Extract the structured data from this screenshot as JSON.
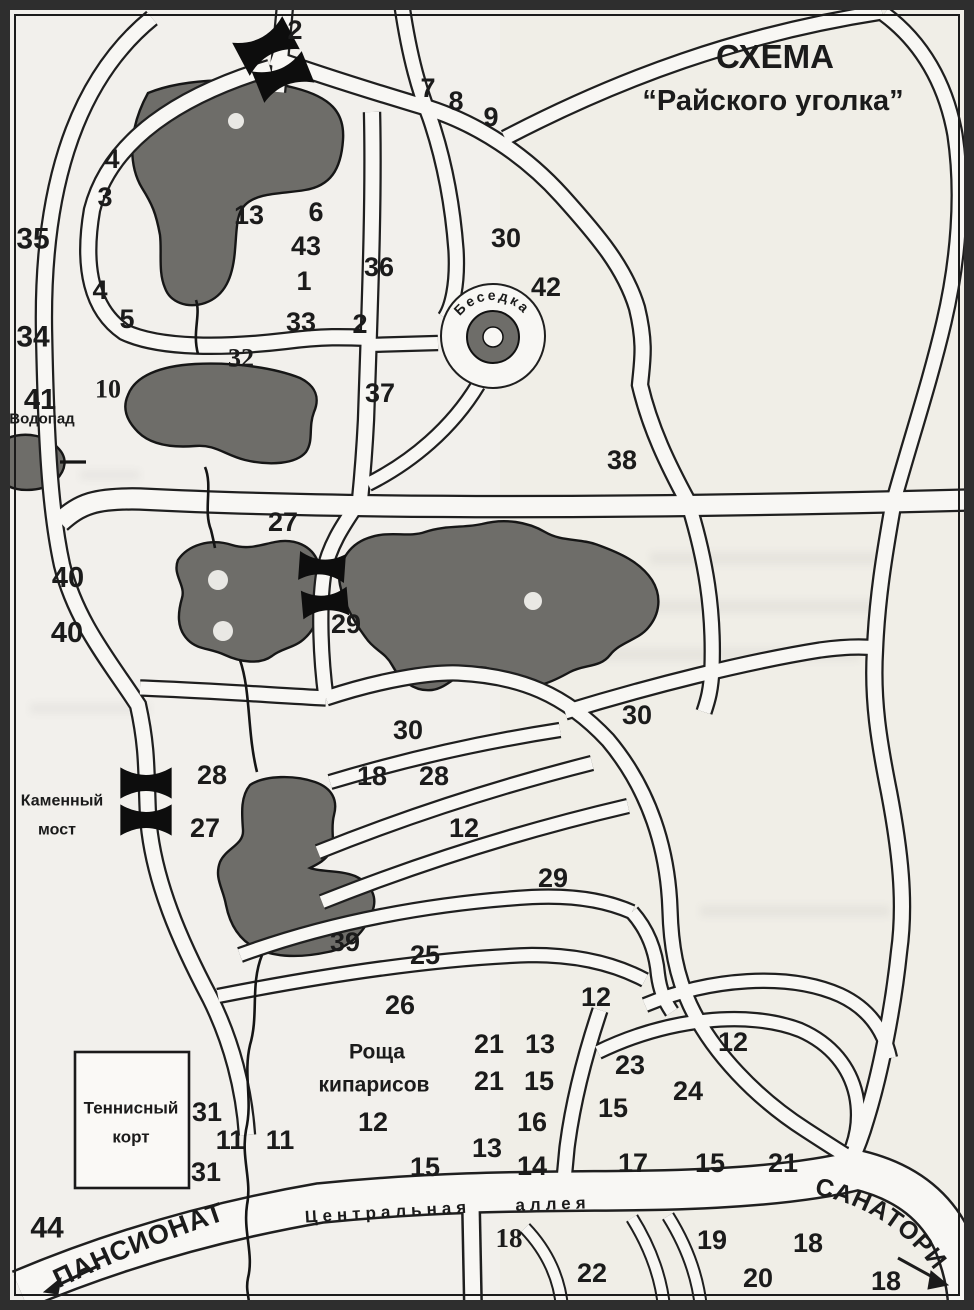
{
  "title": {
    "line1": "СХЕМА",
    "line2": "“Райского уголка”"
  },
  "colors": {
    "paper": "#f2f0ec",
    "road_fill": "#f8f7f4",
    "outline": "#1f1f1f",
    "pond": "#6e6d69",
    "border": "#2e2e2e",
    "text": "#1b1b1b"
  },
  "numbers": [
    {
      "t": "2",
      "x": 295,
      "y": 30
    },
    {
      "t": "7",
      "x": 428,
      "y": 88
    },
    {
      "t": "8",
      "x": 456,
      "y": 101
    },
    {
      "t": "9",
      "x": 491,
      "y": 117
    },
    {
      "t": "4",
      "x": 112,
      "y": 159
    },
    {
      "t": "3",
      "x": 105,
      "y": 197
    },
    {
      "t": "35",
      "x": 33,
      "y": 239,
      "s": 30
    },
    {
      "t": "13",
      "x": 249,
      "y": 215
    },
    {
      "t": "6",
      "x": 316,
      "y": 212
    },
    {
      "t": "43",
      "x": 306,
      "y": 246
    },
    {
      "t": "1",
      "x": 304,
      "y": 281
    },
    {
      "t": "36",
      "x": 379,
      "y": 267
    },
    {
      "t": "30",
      "x": 506,
      "y": 238
    },
    {
      "t": "42",
      "x": 546,
      "y": 287
    },
    {
      "t": "4",
      "x": 100,
      "y": 290
    },
    {
      "t": "5",
      "x": 127,
      "y": 319
    },
    {
      "t": "34",
      "x": 33,
      "y": 337,
      "s": 30
    },
    {
      "t": "33",
      "x": 301,
      "y": 322
    },
    {
      "t": "2",
      "x": 360,
      "y": 324
    },
    {
      "t": "32",
      "x": 241,
      "y": 358,
      "f": 1,
      "s": 26
    },
    {
      "t": "10",
      "x": 108,
      "y": 389,
      "f": 1,
      "s": 26
    },
    {
      "t": "41",
      "x": 40,
      "y": 400,
      "s": 29
    },
    {
      "t": "37",
      "x": 380,
      "y": 393
    },
    {
      "t": "38",
      "x": 622,
      "y": 460
    },
    {
      "t": "27",
      "x": 283,
      "y": 522
    },
    {
      "t": "40",
      "x": 68,
      "y": 578,
      "s": 29
    },
    {
      "t": "40",
      "x": 67,
      "y": 633,
      "s": 29
    },
    {
      "t": "29",
      "x": 346,
      "y": 624
    },
    {
      "t": "30",
      "x": 637,
      "y": 715
    },
    {
      "t": "30",
      "x": 408,
      "y": 730
    },
    {
      "t": "28",
      "x": 212,
      "y": 775
    },
    {
      "t": "18",
      "x": 372,
      "y": 776
    },
    {
      "t": "28",
      "x": 434,
      "y": 776
    },
    {
      "t": "27",
      "x": 205,
      "y": 828
    },
    {
      "t": "12",
      "x": 464,
      "y": 828
    },
    {
      "t": "29",
      "x": 553,
      "y": 878
    },
    {
      "t": "39",
      "x": 345,
      "y": 942
    },
    {
      "t": "25",
      "x": 425,
      "y": 955
    },
    {
      "t": "26",
      "x": 400,
      "y": 1005
    },
    {
      "t": "12",
      "x": 596,
      "y": 997
    },
    {
      "t": "21",
      "x": 489,
      "y": 1044
    },
    {
      "t": "13",
      "x": 540,
      "y": 1044
    },
    {
      "t": "21",
      "x": 489,
      "y": 1081
    },
    {
      "t": "15",
      "x": 539,
      "y": 1081
    },
    {
      "t": "23",
      "x": 630,
      "y": 1065
    },
    {
      "t": "24",
      "x": 688,
      "y": 1091
    },
    {
      "t": "12",
      "x": 733,
      "y": 1042
    },
    {
      "t": "15",
      "x": 613,
      "y": 1108
    },
    {
      "t": "31",
      "x": 207,
      "y": 1112
    },
    {
      "t": "11",
      "x": 230,
      "y": 1140
    },
    {
      "t": "11",
      "x": 280,
      "y": 1140
    },
    {
      "t": "31",
      "x": 206,
      "y": 1172
    },
    {
      "t": "12",
      "x": 373,
      "y": 1122
    },
    {
      "t": "16",
      "x": 532,
      "y": 1122
    },
    {
      "t": "13",
      "x": 487,
      "y": 1148
    },
    {
      "t": "14",
      "x": 532,
      "y": 1166
    },
    {
      "t": "15",
      "x": 425,
      "y": 1167
    },
    {
      "t": "17",
      "x": 633,
      "y": 1163
    },
    {
      "t": "15",
      "x": 710,
      "y": 1163
    },
    {
      "t": "21",
      "x": 783,
      "y": 1163
    },
    {
      "t": "44",
      "x": 47,
      "y": 1228,
      "s": 30
    },
    {
      "t": "18",
      "x": 509,
      "y": 1238,
      "f": 1,
      "s": 27
    },
    {
      "t": "22",
      "x": 592,
      "y": 1273
    },
    {
      "t": "19",
      "x": 712,
      "y": 1240
    },
    {
      "t": "18",
      "x": 808,
      "y": 1243
    },
    {
      "t": "20",
      "x": 758,
      "y": 1278
    },
    {
      "t": "18",
      "x": 886,
      "y": 1281
    }
  ],
  "labels": [
    {
      "id": "waterfall-label",
      "t": "Водопад",
      "x": 42,
      "y": 419,
      "s": 15
    },
    {
      "id": "stone-bridge-label-1",
      "t": "Каменный",
      "x": 62,
      "y": 801,
      "s": 16
    },
    {
      "id": "stone-bridge-label-2",
      "t": "мост",
      "x": 57,
      "y": 830,
      "s": 16
    },
    {
      "id": "tennis-court-label-1",
      "t": "Теннисный",
      "x": 131,
      "y": 1108,
      "s": 17
    },
    {
      "id": "tennis-court-label-2",
      "t": "корт",
      "x": 131,
      "y": 1137,
      "s": 17
    },
    {
      "id": "cypress-grove-label-1",
      "t": "Роща",
      "x": 377,
      "y": 1052,
      "s": 21
    },
    {
      "id": "cypress-grove-label-2",
      "t": "кипарисов",
      "x": 374,
      "y": 1085,
      "s": 21
    },
    {
      "id": "central-alley-label-1",
      "t": "Центральная",
      "x": 388,
      "y": 1212,
      "s": 17,
      "r": -3.5,
      "ls": 5
    },
    {
      "id": "central-alley-label-2",
      "t": "аллея",
      "x": 553,
      "y": 1204,
      "s": 17,
      "r": -2,
      "ls": 5
    }
  ],
  "curved_labels": [
    {
      "id": "gazebo-label",
      "t": "Беседка",
      "path": "arc-besedka",
      "s": 14,
      "ls": 2.5,
      "anchor": "middle",
      "offset": "50%"
    },
    {
      "id": "pansionat-label",
      "t": "ПАНСИОНАТ",
      "path": "arc-pansionat",
      "s": 27,
      "ls": 1,
      "anchor": "start",
      "offset": "4"
    },
    {
      "id": "sanatoriy-label",
      "t": "САНАТОРИЙ",
      "path": "arc-sanatoriy",
      "s": 25,
      "ls": 1,
      "anchor": "start",
      "offset": "2"
    }
  ]
}
